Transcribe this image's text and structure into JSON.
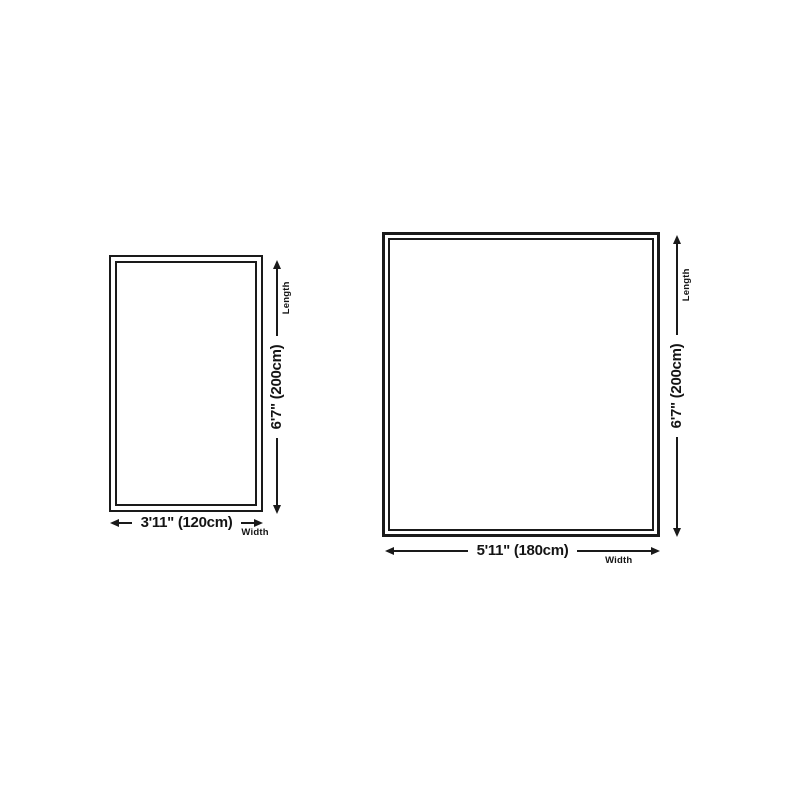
{
  "page": {
    "background_color": "#ffffff",
    "ink_color": "#1a1a1a"
  },
  "figures": [
    {
      "name": "small-size-diagram",
      "width_label": "3'11\" (120cm)",
      "width_caption": "Width",
      "length_label": "6'7\" (200cm)",
      "length_caption": "Length",
      "width_cm": 120,
      "length_cm": 200
    },
    {
      "name": "large-size-diagram",
      "width_label": "5'11\" (180cm)",
      "width_caption": "Width",
      "length_label": "6'7\" (200cm)",
      "length_caption": "Length",
      "width_cm": 180,
      "length_cm": 200
    }
  ]
}
